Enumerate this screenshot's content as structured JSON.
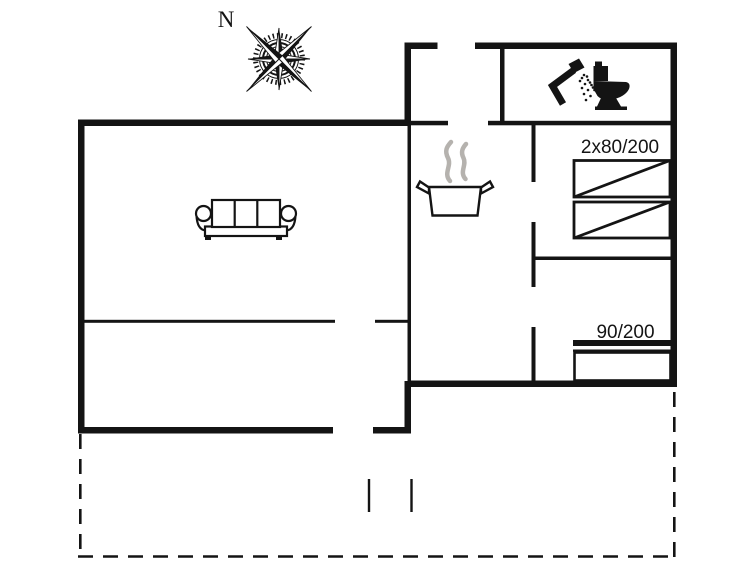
{
  "plan": {
    "type_label": "floor-plan",
    "background": "#ffffff"
  },
  "colors": {
    "line": "#141414",
    "steam": "#b5b2ae",
    "text": "#141414"
  },
  "compass": {
    "label": "N",
    "icon": "compass-rose-icon"
  },
  "rooms": {
    "bedroom1": {
      "bed_label": "2x80/200",
      "beds_icon": "single-bed-icon"
    },
    "bedroom2": {
      "bed_label": "90/200",
      "bed_icon": "single-bed-icon"
    },
    "bathroom": {
      "icons": [
        "shower-icon",
        "toilet-icon"
      ]
    },
    "kitchen": {
      "icons": [
        "cooking-pot-icon",
        "steam-icon"
      ]
    },
    "living": {
      "icons": [
        "sofa-icon"
      ]
    },
    "terrace": {
      "outline": "dashed"
    }
  }
}
